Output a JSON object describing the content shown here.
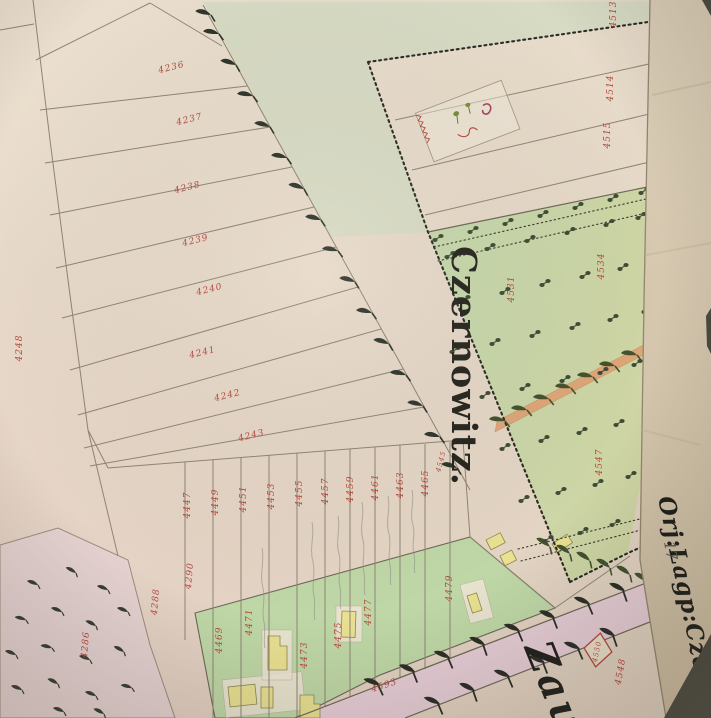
{
  "labels": {
    "city": "Czernowitz.",
    "margin": "Orj:Lagp:Czern",
    "margin_mark": "17",
    "bottom": "Zau"
  },
  "colors": {
    "paper": "#e6d9c9",
    "pale_wedge": "#d6dac3",
    "orchard_green": "#c8d9ae",
    "garden_green": "#bfd7a6",
    "pink_parcel": "#e5d2d0",
    "road_pink": "#e6cdd5",
    "orange_path": "#dfa173",
    "margin_paper": "#d8cab2",
    "building_yellow": "#e9e092",
    "number_red": "#b4483c",
    "ink_black": "#26261f",
    "tree_dark": "#343b2e"
  },
  "symbols": {
    "tree": "hook-tree-symbol",
    "orchard_tree": "paired-dot-tree-symbol",
    "shrub": "bush-tick-symbol",
    "survey_marker": "red-diamond-marker"
  },
  "parcel_numbers": [
    {
      "value": "4236"
    },
    {
      "value": "4237"
    },
    {
      "value": "4238"
    },
    {
      "value": "4239"
    },
    {
      "value": "4240"
    },
    {
      "value": "4241"
    },
    {
      "value": "4242"
    },
    {
      "value": "4243"
    },
    {
      "value": "4248"
    },
    {
      "value": "4447"
    },
    {
      "value": "4449"
    },
    {
      "value": "4451"
    },
    {
      "value": "4453"
    },
    {
      "value": "4455"
    },
    {
      "value": "4457"
    },
    {
      "value": "4459"
    },
    {
      "value": "4461"
    },
    {
      "value": "4463"
    },
    {
      "value": "4465"
    },
    {
      "value": "4469"
    },
    {
      "value": "4471"
    },
    {
      "value": "4473"
    },
    {
      "value": "4475"
    },
    {
      "value": "4477"
    },
    {
      "value": "4479"
    },
    {
      "value": "4288"
    },
    {
      "value": "4290"
    },
    {
      "value": "4286"
    },
    {
      "value": "4513"
    },
    {
      "value": "4514"
    },
    {
      "value": "4515"
    },
    {
      "value": "4534"
    },
    {
      "value": "4531"
    },
    {
      "value": "4547"
    },
    {
      "value": "4545"
    },
    {
      "value": "4593"
    },
    {
      "value": "4548"
    },
    {
      "value": "4550"
    }
  ]
}
